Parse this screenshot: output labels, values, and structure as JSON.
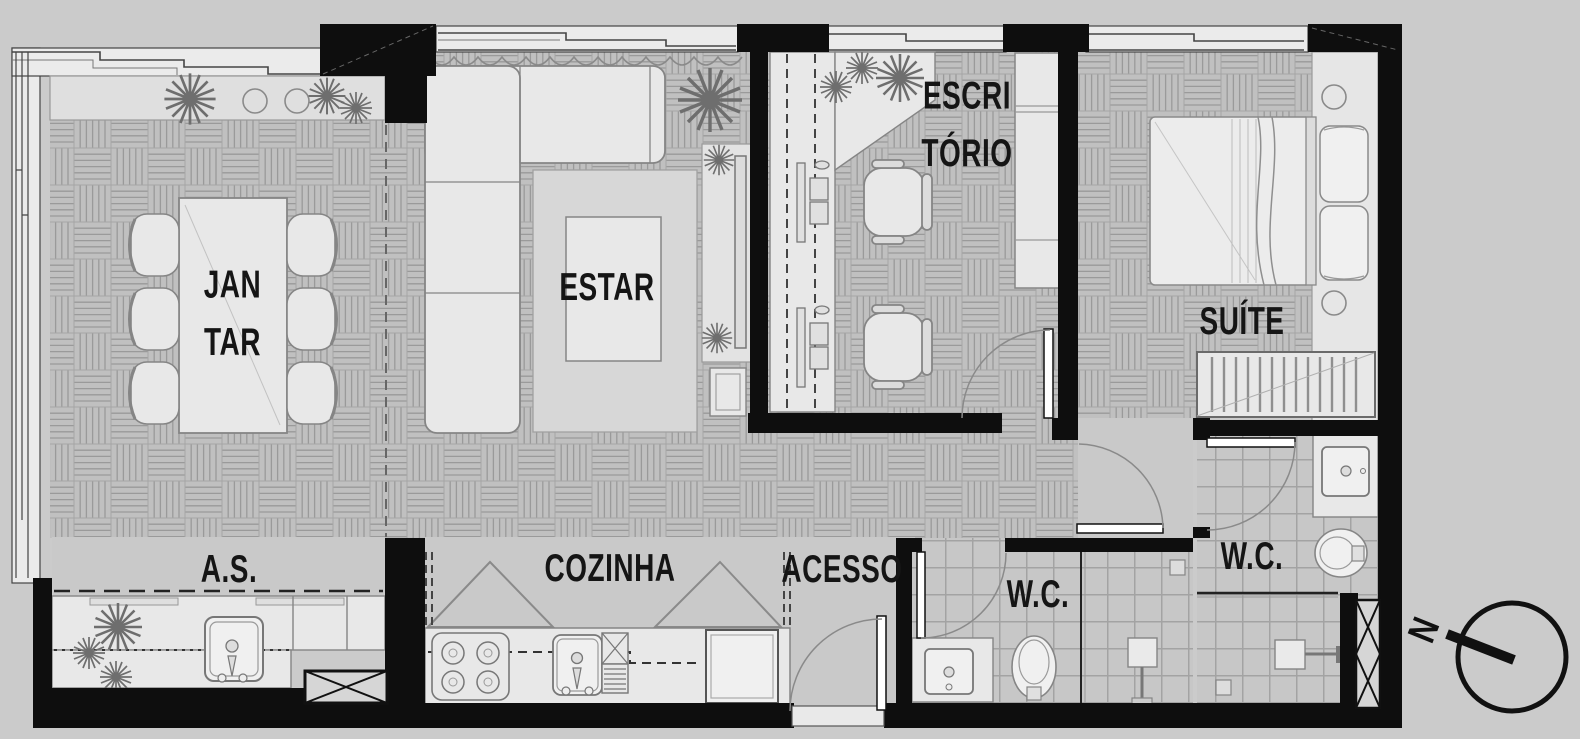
{
  "meta": {
    "type": "apartment floor plan"
  },
  "rooms": {
    "jantar": {
      "label": "JAN\nTAR"
    },
    "estar": {
      "label": "ESTAR"
    },
    "escritorio": {
      "label": "ESCRI\nTÓRIO"
    },
    "suite": {
      "label": "SUÍTE"
    },
    "area_servico": {
      "label": "A.S."
    },
    "cozinha": {
      "label": "COZINHA"
    },
    "acesso": {
      "label": "ACESSO"
    },
    "wc_social": {
      "label": "W.C."
    },
    "wc_suite": {
      "label": "W.C."
    }
  },
  "compass": {
    "north_label": "N"
  },
  "colors": {
    "background": "#cbcbcb",
    "wall": "#0e0e0e",
    "parquet_floor": "#c0c0c0",
    "parquet_line": "#9a9a9a",
    "tile_floor": "#c7c7c7",
    "plain_floor": "#c9c9c9",
    "furniture_fill": "#e8e8e8",
    "furniture_stroke": "#858585",
    "label_text": "#151515"
  }
}
